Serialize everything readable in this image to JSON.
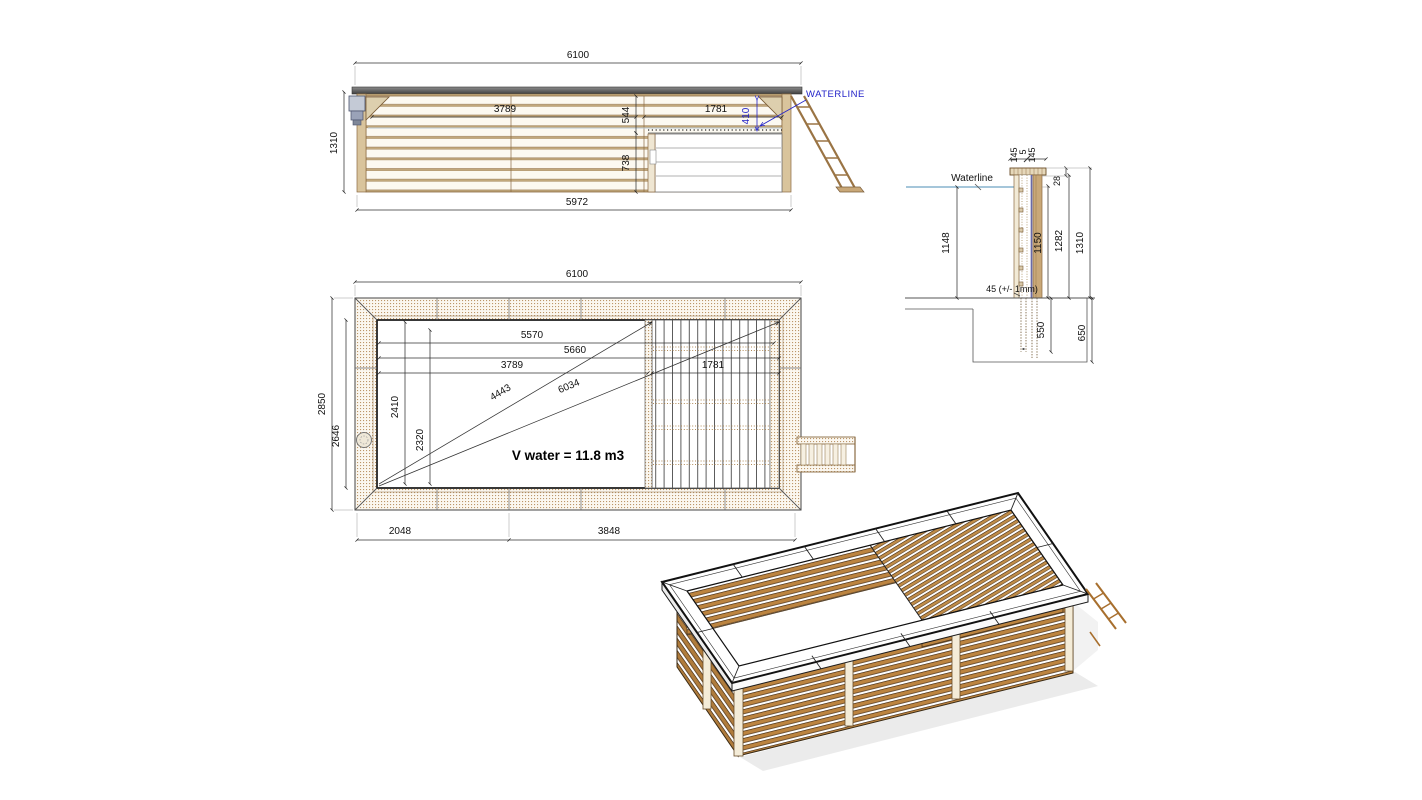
{
  "colors": {
    "background": "#ffffff",
    "dim_line": "#333333",
    "dim_text": "#111111",
    "blue_annotation": "#2323c8",
    "waterline_blue": "#a5c6da",
    "wood_outline": "#8a6a42",
    "wood_fill": "#c9a878",
    "wood_3d": "#bc8440",
    "coping_gray": "#5a5a5a"
  },
  "elevation_view": {
    "dims": {
      "overall_length": "6100",
      "overall_height": "1310",
      "base_length": "5972",
      "swim_zone_length": "3789",
      "deck_offset": "544",
      "deck_length": "1781",
      "waterline_offset": "410",
      "deck_depth": "738"
    },
    "waterline_label": "WATERLINE"
  },
  "plan_view": {
    "dims": {
      "overall_length": "6100",
      "overall_width": "2850",
      "inner_width": "2646",
      "liner_length": "5570",
      "inner_length": "5660",
      "swim_zone_length": "3789",
      "deck_length": "1781",
      "inner_width_a": "2410",
      "inner_width_b": "2320",
      "diagonal_short": "4443",
      "diagonal_long": "6034",
      "bottom_left_segment": "2048",
      "bottom_right_segment": "3848"
    },
    "volume_label": "V water = 11.8 m3"
  },
  "section_view": {
    "dims": {
      "coping_board_a": "145",
      "coping_gap": "5",
      "coping_board_b": "145",
      "coping_rise": "28",
      "water_depth": "1148",
      "wall_height_inner": "1150",
      "wall_height_mid": "1282",
      "wall_height_outer": "1310",
      "plank_thickness": "45 (+/- 1mm)",
      "post_embed_depth": "550",
      "foundation_depth": "650"
    },
    "waterline_label": "Waterline"
  }
}
